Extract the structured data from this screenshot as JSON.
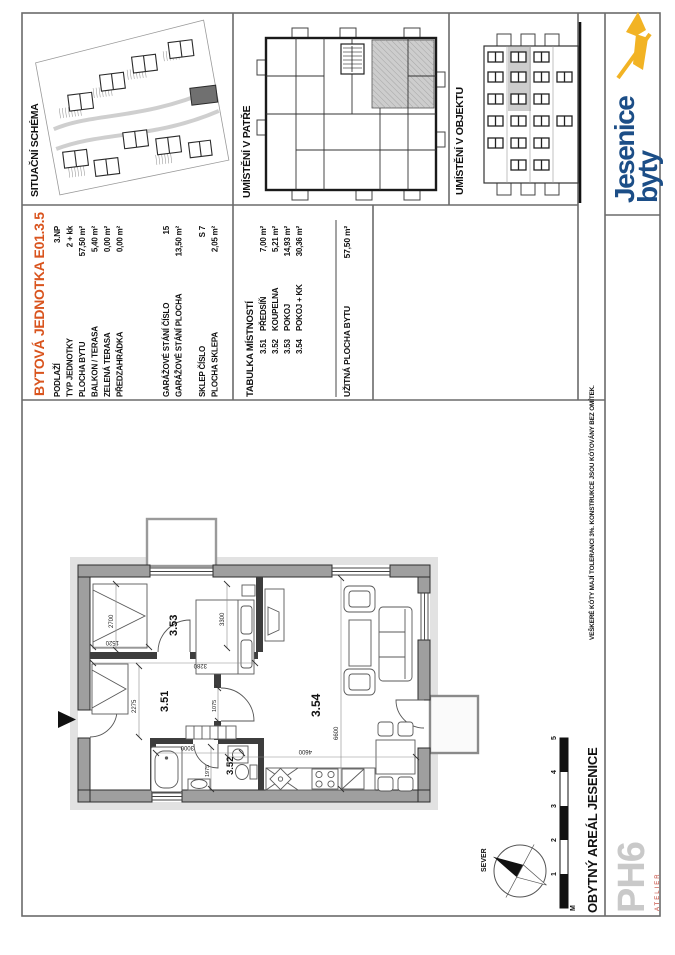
{
  "panels": {
    "situation_label": "SITUAČNÍ SCHÉMA",
    "floor_label": "UMÍSTĚNÍ V PATŘE",
    "building_label": "UMÍSTĚNÍ V OBJEKTU"
  },
  "logo": {
    "line1": "byty",
    "line2": "Jesenice"
  },
  "unit_table": {
    "title": "BYTOVÁ JEDNOTKA E01.3.5",
    "rows": [
      {
        "label": "PODLAŽÍ",
        "value": "3.NP"
      },
      {
        "label": "TYP JEDNOTKY",
        "value": "2 + kk"
      },
      {
        "label": "PLOCHA BYTU",
        "value": "57,50 m²"
      },
      {
        "label": "BALKON / TERASA",
        "value": "5,40 m²"
      },
      {
        "label": "ZELENÁ TERASA",
        "value": "0,00 m²"
      },
      {
        "label": "PŘEDZAHRÁDKA",
        "value": "0,00 m²"
      },
      {
        "label": "GARÁŽOVÉ STÁNÍ ČÍSLO",
        "value": "15"
      },
      {
        "label": "GARÁŽOVÉ STÁNÍ PLOCHA",
        "value": "13,50 m²"
      },
      {
        "label": "SKLEP ČÍSLO",
        "value": "S 7"
      },
      {
        "label": "PLOCHA SKLEPA",
        "value": "2,05 m²"
      }
    ]
  },
  "room_table": {
    "title": "TABULKA MÍSTNOSTÍ",
    "rows": [
      {
        "num": "3.51",
        "name": "PŘEDSÍŇ",
        "area": "7,00 m²"
      },
      {
        "num": "3.52",
        "name": "KOUPELNA",
        "area": "5,21 m²"
      },
      {
        "num": "3.53",
        "name": "POKOJ",
        "area": "14,93 m²"
      },
      {
        "num": "3.54",
        "name": "POKOJ + KK",
        "area": "30,36 m²"
      }
    ],
    "total_label": "UŽITNÁ PLOCHA BYTU",
    "total_value": "57,50 m²"
  },
  "plan": {
    "rooms": {
      "r351": "3.51",
      "r352": "3.52",
      "r353": "3.53",
      "r354": "3.54"
    },
    "dims": {
      "d2700": "2700",
      "d1520": "1520",
      "d3300": "3300",
      "d3280": "3280",
      "d2275": "2275",
      "d1075": "1075",
      "d3000": "3000",
      "d1975": "1975",
      "d4600": "4600",
      "d6600": "6600"
    }
  },
  "titleblock": {
    "project": "OBYTNÝ AREÁL JESENICE",
    "north": "SEVER",
    "unit": "M",
    "ticks": [
      "1",
      "2",
      "3",
      "4",
      "5"
    ],
    "atelier_name": "PH6",
    "atelier_sub": "ATELIER"
  },
  "note": "VEŠKERÉ KÓTY MAJÍ TOLERANCI 3%. KONSTRUKCE JSOU KÓTOVÁNY BEZ OMÍTEK.",
  "colors": {
    "accent": "#D9541E",
    "logo_blue": "#1C4E87",
    "logo_yellow": "#F2B324",
    "atelier_red": "#C0392B",
    "wall_gray": "#9f9f9f",
    "highlight_gray": "#c9c9c9"
  }
}
